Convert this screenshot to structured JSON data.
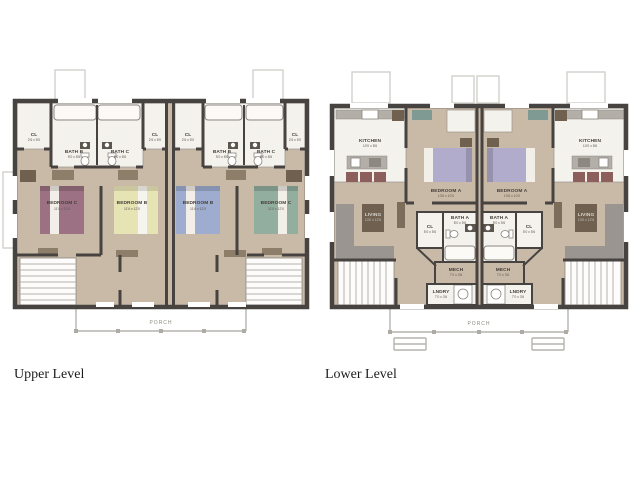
{
  "upper": {
    "title": "Upper Level",
    "porch": "PORCH",
    "cl": "CL",
    "cl_dim": "2'6 x 5'0",
    "bath_b": "BATH B",
    "bath_b_dim": "5'0 x 8'6",
    "bath_c": "BATH C",
    "bath_c_dim": "5'0 x 8'6",
    "bedroom_b": "BEDROOM B",
    "bedroom_b_dim": "11'6 x 12'0",
    "bedroom_c": "BEDROOM C",
    "bedroom_c_dim": "11'0 x 12'0"
  },
  "lower": {
    "title": "Lower Level",
    "porch": "PORCH",
    "kitchen": "KITCHEN",
    "kitchen_dim": "10'0 x 8'6",
    "bedroom_a": "BEDROOM A",
    "bedroom_a_dim": "13'6 x 10'0",
    "living": "LIVING",
    "living_dim": "13'0 x 12'6",
    "cl": "CL",
    "cl_dim": "5'0 x 5'6",
    "bath_a": "BATH A",
    "bath_a_dim": "8'0 x 5'6",
    "mech": "MECH",
    "mech_dim": "7'0 x 3'6",
    "lndry": "LNDRY",
    "lndry_dim": "7'0 x 3'6"
  },
  "colors": {
    "wall": "#474340",
    "floor": "#c9baa8",
    "white_room": "#f4f2ed",
    "bed_mauve": "#9c7183",
    "bed_yellow": "#e6e3b4",
    "bed_blue": "#9daccf",
    "bed_green": "#92ae9f",
    "bed_lavender": "#b1abcc",
    "sofa": "#9a9591",
    "stool_maroon": "#8c5f5c",
    "porch_line": "#b6b3ad"
  }
}
